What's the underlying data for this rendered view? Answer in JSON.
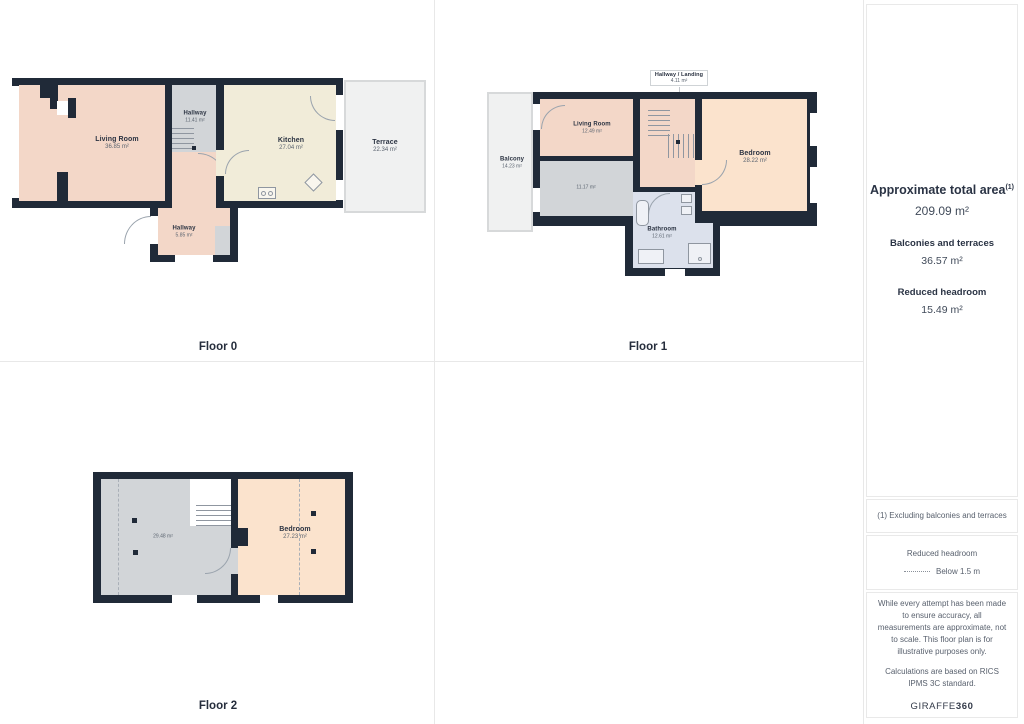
{
  "floors": [
    {
      "label": "Floor 0",
      "rooms": [
        {
          "name": "Living Room",
          "area": "36.85 m²"
        },
        {
          "name": "Hallway",
          "area": "11.41 m²"
        },
        {
          "name": "Kitchen",
          "area": "27.04 m²"
        },
        {
          "name": "Terrace",
          "area": "22.34 m²"
        },
        {
          "name": "Hallway",
          "area": "5.85 m²"
        }
      ]
    },
    {
      "label": "Floor 1",
      "rooms": [
        {
          "name": "Hallway / Landing",
          "area": "4.11 m²"
        },
        {
          "name": "Balcony",
          "area": "14.23 m²"
        },
        {
          "name": "Living Room",
          "area": "12.49 m²"
        },
        {
          "name": "",
          "area": "11.17 m²"
        },
        {
          "name": "Bedroom",
          "area": "28.22 m²"
        },
        {
          "name": "Bathroom",
          "area": "12.61 m²"
        }
      ]
    },
    {
      "label": "Floor 2",
      "rooms": [
        {
          "name": "",
          "area": "29.48 m²"
        },
        {
          "name": "Bedroom",
          "area": "27.23 m²"
        }
      ]
    }
  ],
  "summary": {
    "total_label": "Approximate total area",
    "total_sup": "(1)",
    "total_value": "209.09 m²",
    "balconies_label": "Balconies and terraces",
    "balconies_value": "36.57 m²",
    "headroom_label": "Reduced headroom",
    "headroom_value": "15.49 m²"
  },
  "notes": {
    "footnote": "(1) Excluding balconies and terraces",
    "legend_title": "Reduced headroom",
    "legend_value": "Below 1.5 m",
    "disclaimer_1": "While every attempt has been made to ensure accuracy, all measurements are approximate, not to scale. This floor plan is for illustrative purposes only.",
    "disclaimer_2": "Calculations are based on RICS IPMS 3C standard.",
    "brand_regular": "GIRAFFE",
    "brand_bold": "360"
  },
  "colors": {
    "wall": "#202a38",
    "room_pink": "#f3d7c8",
    "room_cream": "#f1ecd9",
    "room_gray": "#d2d5d8",
    "room_peach": "#fbe3cd",
    "room_bath": "#dce1ec",
    "outdoor": "#f0f1f1",
    "grid_line": "#e8e8e8",
    "text_dark": "#2a3344",
    "text_muted": "#59616e"
  }
}
